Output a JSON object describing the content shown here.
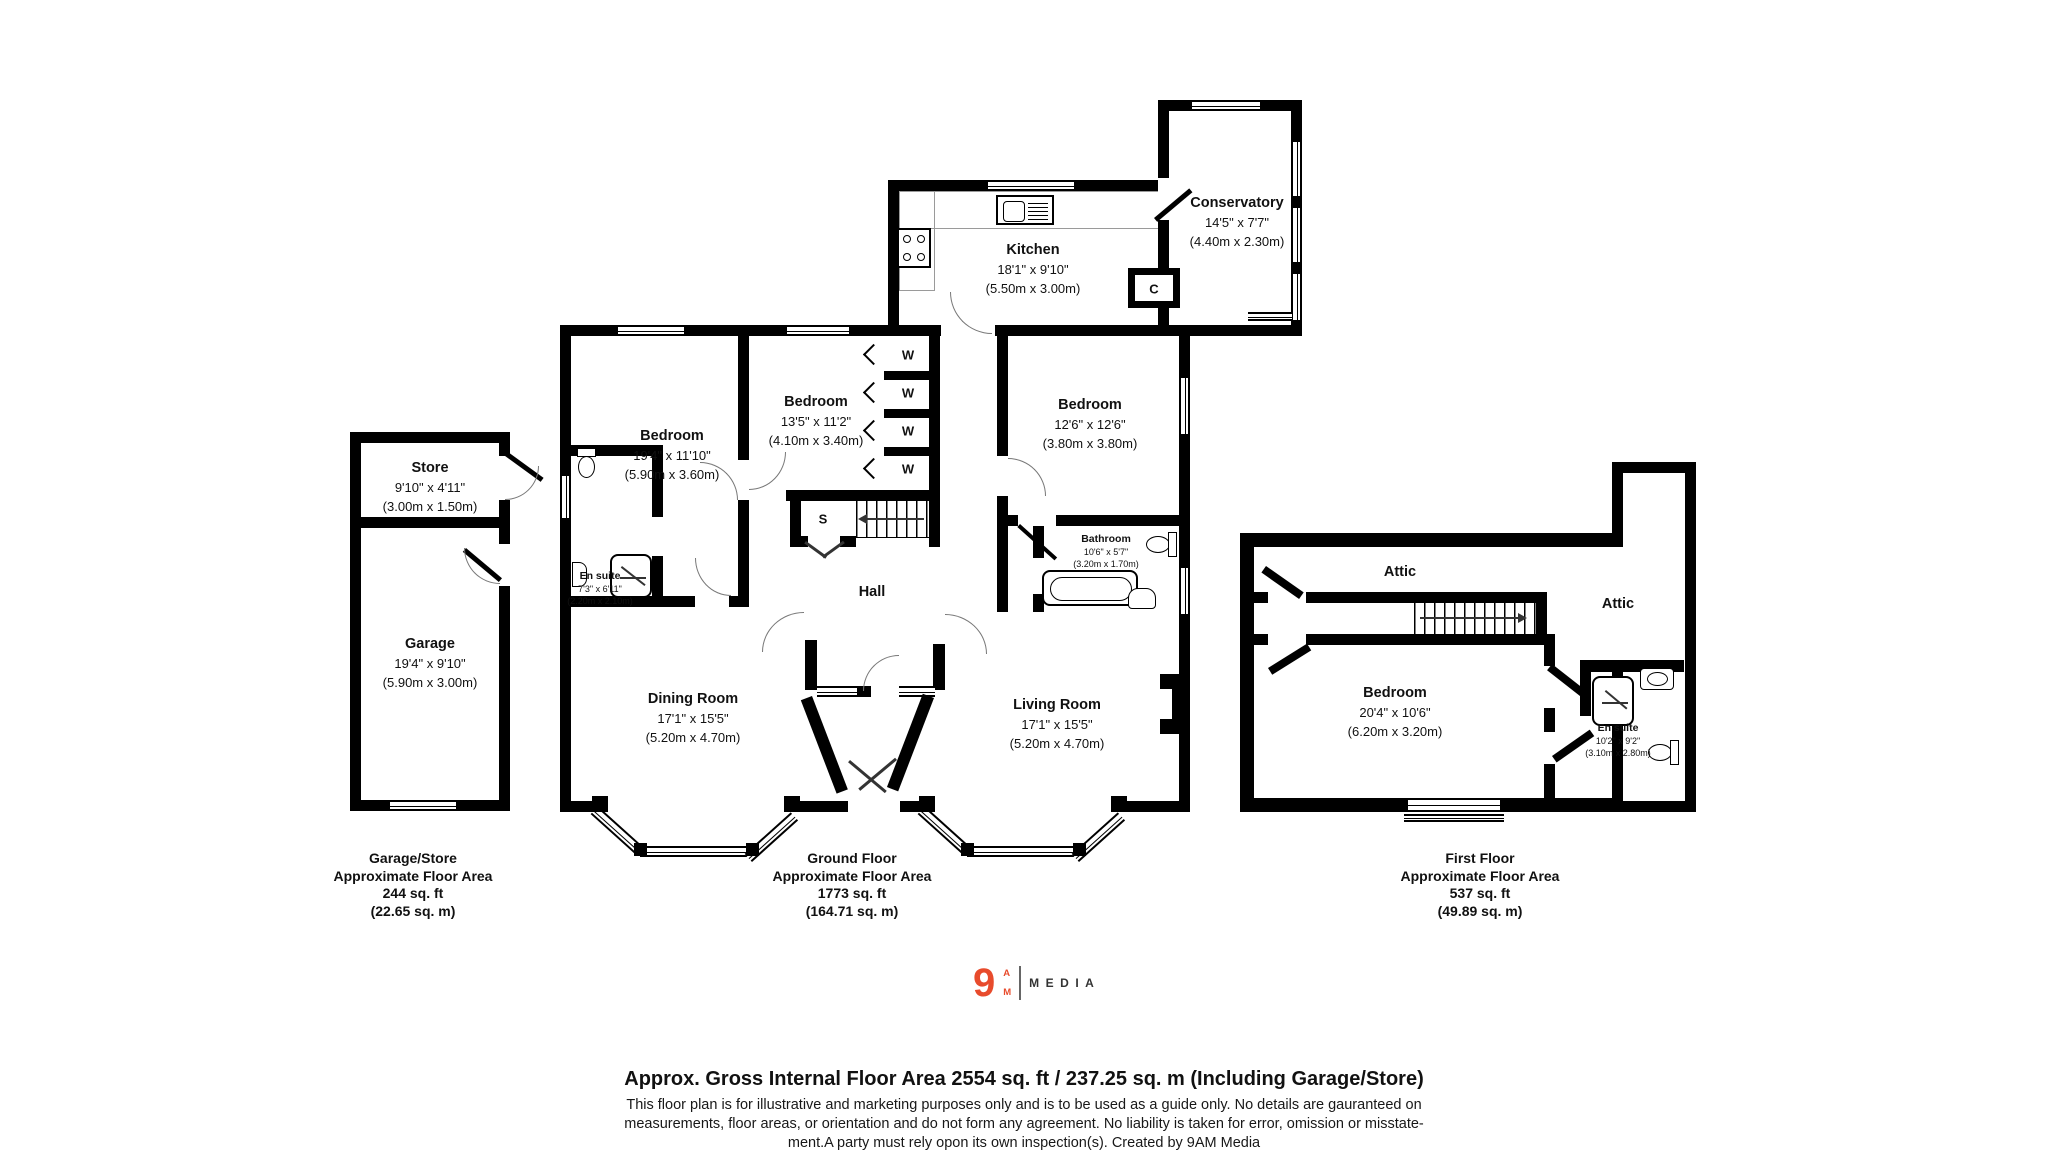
{
  "colors": {
    "wall": "#000000",
    "logo_orange": "#e84b2c",
    "logo_gray": "#666666",
    "text": "#111111"
  },
  "garage_store_plan": {
    "store": {
      "name": "Store",
      "dims": "9'10\" x 4'11\"",
      "metric": "(3.00m x 1.50m)"
    },
    "garage": {
      "name": "Garage",
      "dims": "19'4\" x 9'10\"",
      "metric": "(5.90m x 3.00m)"
    },
    "caption": {
      "title": "Garage/Store",
      "subtitle": "Approximate Floor Area",
      "area_ft": "244 sq. ft",
      "area_m": "(22.65 sq. m)"
    }
  },
  "ground_floor_plan": {
    "kitchen": {
      "name": "Kitchen",
      "dims": "18'1\" x 9'10\"",
      "metric": "(5.50m x 3.00m)"
    },
    "conservatory": {
      "name": "Conservatory",
      "dims": "14'5\" x 7'7\"",
      "metric": "(4.40m x 2.30m)"
    },
    "closet": {
      "name": "C"
    },
    "bedroom1": {
      "name": "Bedroom",
      "dims": "19'4\" x 11'10\"",
      "metric": "(5.90m x 3.60m)"
    },
    "bedroom2": {
      "name": "Bedroom",
      "dims": "13'5\" x 11'2\"",
      "metric": "(4.10m x 3.40m)"
    },
    "bedroom3": {
      "name": "Bedroom",
      "dims": "12'6\" x 12'6\"",
      "metric": "(3.80m x 3.80m)"
    },
    "ensuite": {
      "name": "En suite",
      "dims": "7'3\" x 6'11\"",
      "metric": "(2.20m x 2.10m)"
    },
    "bathroom": {
      "name": "Bathroom",
      "dims": "10'6\" x 5'7\"",
      "metric": "(3.20m x 1.70m)"
    },
    "hall": {
      "name": "Hall"
    },
    "store_cupboard": {
      "name": "S"
    },
    "wardrobe": {
      "name": "W"
    },
    "dining": {
      "name": "Dining Room",
      "dims": "17'1\" x 15'5\"",
      "metric": "(5.20m x 4.70m)"
    },
    "living": {
      "name": "Living Room",
      "dims": "17'1\" x 15'5\"",
      "metric": "(5.20m x 4.70m)"
    },
    "caption": {
      "title": "Ground Floor",
      "subtitle": "Approximate Floor Area",
      "area_ft": "1773 sq. ft",
      "area_m": "(164.71 sq. m)"
    }
  },
  "first_floor_plan": {
    "attic_left": {
      "name": "Attic"
    },
    "attic_right": {
      "name": "Attic"
    },
    "bedroom": {
      "name": "Bedroom",
      "dims": "20'4\" x 10'6\"",
      "metric": "(6.20m x 3.20m)"
    },
    "ensuite": {
      "name": "En suite",
      "dims": "10'2\" x 9'2\"",
      "metric": "(3.10m x 2.80m)"
    },
    "caption": {
      "title": "First Floor",
      "subtitle": "Approximate Floor Area",
      "area_ft": "537 sq. ft",
      "area_m": "(49.89 sq. m)"
    }
  },
  "logo": {
    "numeral": "9",
    "letter_a": "A",
    "letter_m": "M",
    "wordmark": "MEDIA"
  },
  "footer": {
    "title": "Approx. Gross Internal Floor Area 2554 sq. ft / 237.25 sq. m (Including Garage/Store)",
    "disclaimer1": "This floor plan is for illustrative and marketing purposes only and is to be used as a guide only. No details are gauranteed on",
    "disclaimer2": "measurements, floor areas, or orientation and do not form any agreement. No liability is taken for error, omission or misstate-",
    "disclaimer3": "ment.A party must rely opon its own inspection(s). Created by 9AM Media"
  }
}
